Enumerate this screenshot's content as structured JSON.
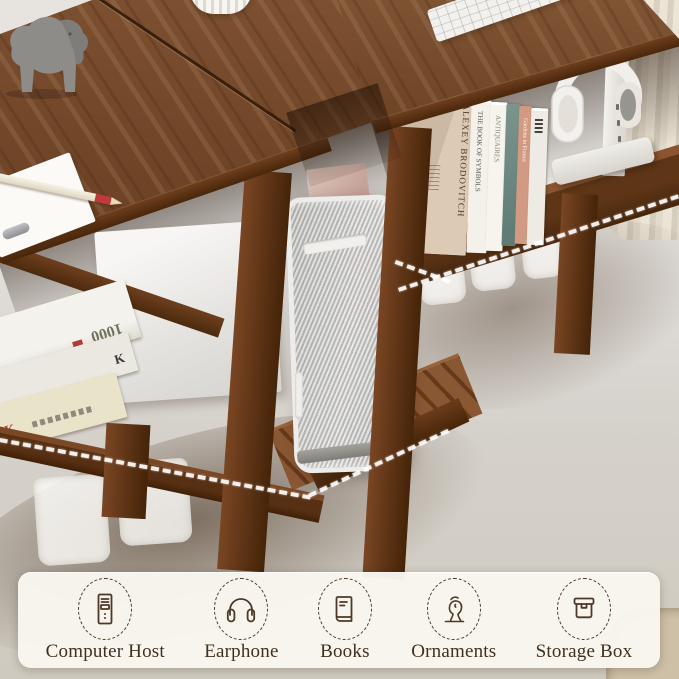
{
  "palette": {
    "walnut": "#7c4a27",
    "walnut_dark": "#49260b",
    "floor": "#b29071",
    "wall": "#e8e5e1",
    "curtain": "#ddd5c4",
    "silver": "#cfcfcd",
    "highlight_dash": "#ffffff",
    "panel_bg": "#faf7f1",
    "icon_stroke": "#4a3420",
    "label_color": "#3b2a18"
  },
  "panel": {
    "items": [
      {
        "label": "Computer Host",
        "icon": "computer-host-icon"
      },
      {
        "label": "Earphone",
        "icon": "earphone-icon"
      },
      {
        "label": "Books",
        "icon": "books-icon"
      },
      {
        "label": "Ornaments",
        "icon": "ornaments-icon"
      },
      {
        "label": "Storage Box",
        "icon": "storage-box-icon"
      }
    ]
  },
  "scene": {
    "shelf_books": [
      {
        "title": "ALEXEY BRODOVITCH"
      },
      {
        "title": "THE BOOK OF SYMBOLS"
      },
      {
        "title": "ANTIQUAIRES"
      },
      {
        "title": ""
      },
      {
        "title": "Gardens in France"
      },
      {
        "title": ""
      }
    ],
    "stacked_books": {
      "top_spine": "1000",
      "middle_spine": "K",
      "bottom_spine": "K"
    }
  }
}
